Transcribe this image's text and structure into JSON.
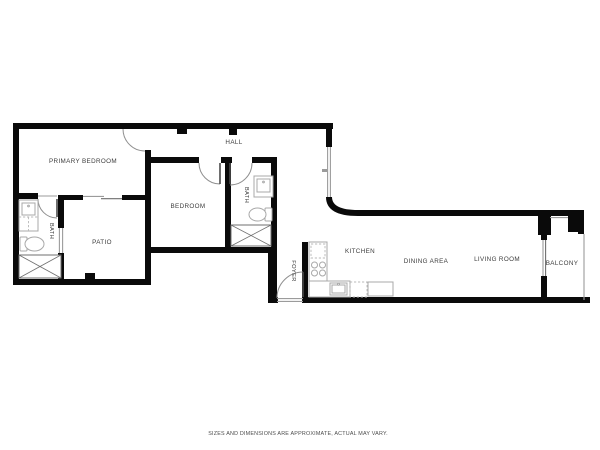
{
  "plan": {
    "type": "residential-floor-plan",
    "rooms": {
      "primary_bedroom": "PRIMARY BEDROOM",
      "hall": "HALL",
      "bedroom": "BEDROOM",
      "bath_primary": "BATH",
      "bath_hall": "BATH",
      "patio": "PATIO",
      "foyer": "FOYER",
      "kitchen": "KITCHEN",
      "dining_area": "DINING AREA",
      "living_room": "LIVING ROOM",
      "balcony": "BALCONY"
    },
    "disclaimer": "SIZES AND DIMENSIONS ARE APPROXIMATE, ACTUAL MAY VARY.",
    "colors": {
      "wall": "#0a0a0a",
      "window_line": "#9b9b9b",
      "fixture_line": "#a8a8a8",
      "label_text": "#3d3d3d",
      "disclaimer_text": "#4d4d4d",
      "background": "#ffffff"
    }
  }
}
